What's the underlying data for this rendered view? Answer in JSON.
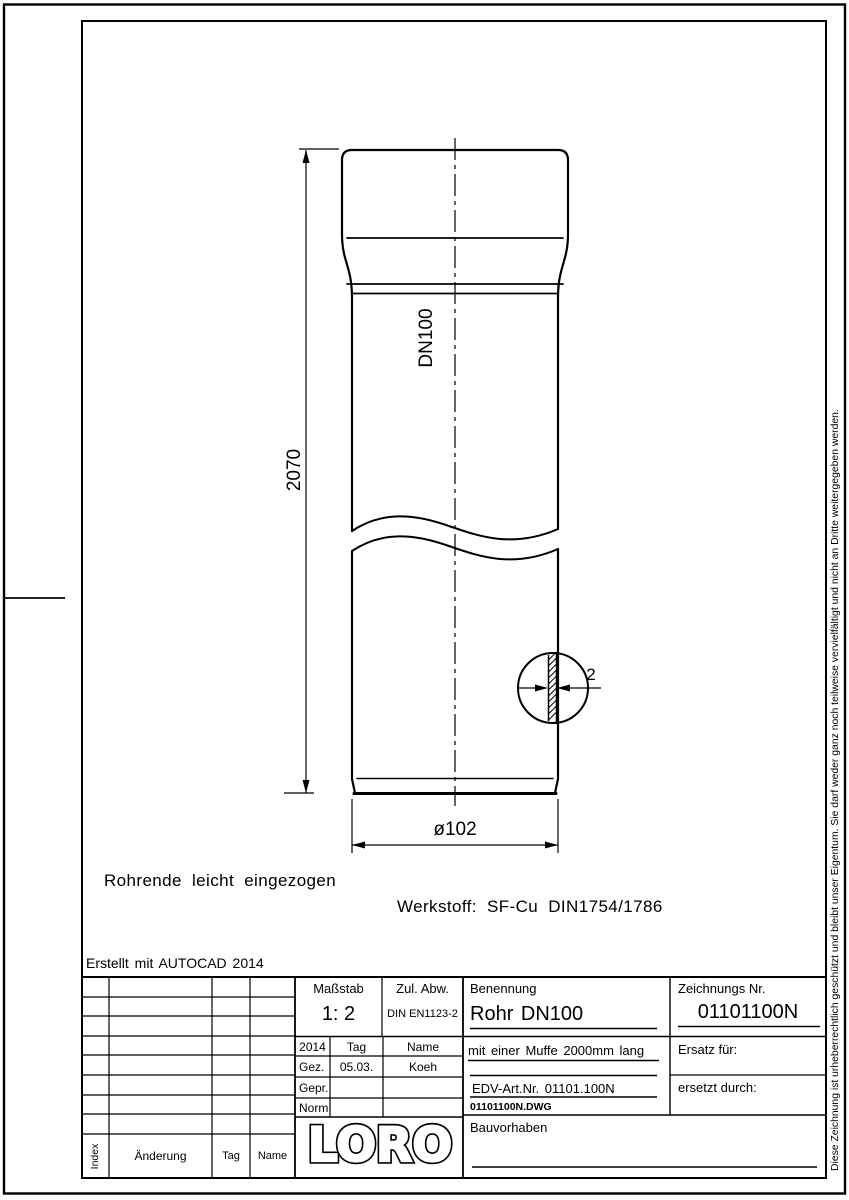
{
  "page": {
    "background": "#ffffff",
    "line_color": "#000000"
  },
  "drawing": {
    "created_with": "Erstellt mit AUTOCAD 2014",
    "note_pipe_end": "Rohrende leicht eingezogen",
    "material": "Werkstoff: SF-Cu DIN1754/1786",
    "length_dim": "2070",
    "pipe_label": "DN100",
    "wall_thickness_dim": "2",
    "diameter_dim": "ø102"
  },
  "title_block": {
    "masstab_label": "Maßstab",
    "masstab_value": "1: 2",
    "zul_abw_label": "Zul. Abw.",
    "zul_abw_value": "DIN EN1123-2",
    "year": "2014",
    "tag_header": "Tag",
    "name_header": "Name",
    "gez_label": "Gez.",
    "gez_date": "05.03.",
    "gez_name": "Koeh",
    "gepr_label": "Gepr.",
    "norm_label": "Norm.",
    "benennung_label": "Benennung",
    "benennung_value": "Rohr DN100",
    "description": "mit einer Muffe 2000mm lang",
    "edv_art": "EDV-Art.Nr. 01101.100N",
    "dwg_file": "01101100N.DWG",
    "zeichnungs_label": "Zeichnungs Nr.",
    "zeichnungs_value": "01101100N",
    "ersatz_label": "Ersatz für:",
    "ersetzt_label": "ersetzt durch:",
    "bauvorhaben_label": "Bauvorhaben",
    "logo_text": "LORO",
    "revision": {
      "index_label": "Index",
      "aenderung_label": "Änderung",
      "tag_label": "Tag",
      "name_label": "Name"
    }
  },
  "copyright_notice": "Diese Zeichnung ist urheberrechtlich geschützt und bleibt unser Eigentum. Sie darf weder ganz noch teilweise vervielfältigt und nicht an Dritte weitergegeben werden."
}
